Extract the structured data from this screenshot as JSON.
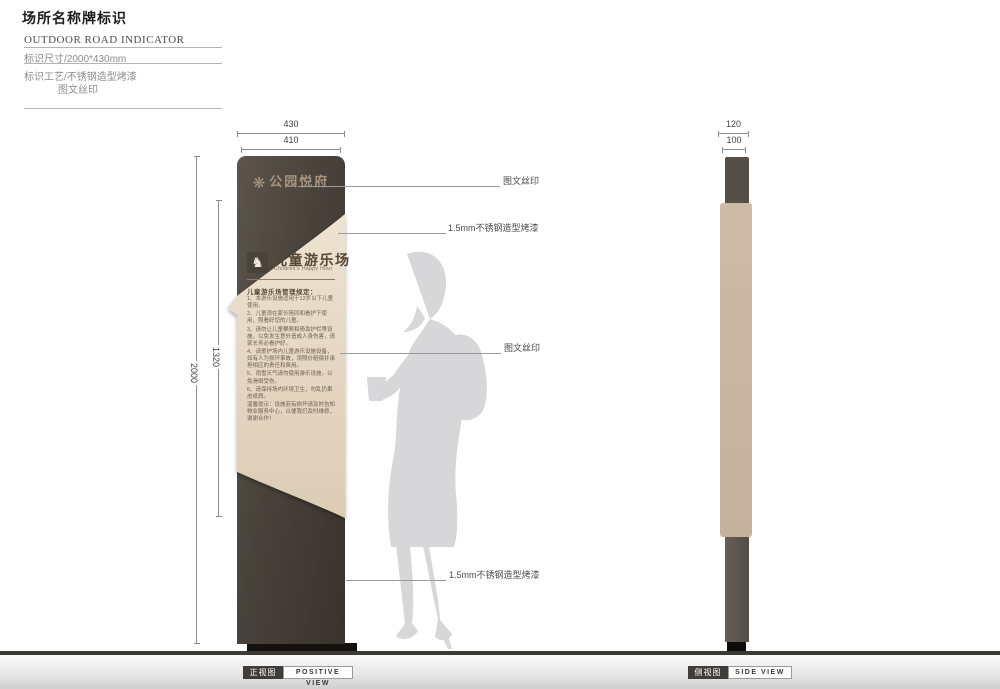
{
  "header": {
    "title": "场所名称牌标识",
    "subtitle": "OUTDOOR ROAD INDICATOR",
    "size_spec": "标识尺寸/2000*430mm",
    "craft_spec_line1": "标识工艺/不锈钢造型烤漆",
    "craft_spec_line2": "图文丝印"
  },
  "front_view": {
    "dims": {
      "outer_width": "430",
      "inner_width": "410",
      "outer_height": "2000",
      "panel_height": "1320"
    },
    "logo": {
      "emblem_glyph": "❋",
      "name": "公园悦府",
      "subname": "· · · · · · · · ·"
    },
    "panel": {
      "icon_glyph": "♞",
      "title_cn": "儿童游乐场",
      "title_en": "Children's Happy Hour",
      "rules_title": "儿童游乐场管理规定：",
      "rules": [
        "1、本游乐设施适用于12岁以下儿童使用。",
        "2、儿童须在家长陪同和看护下使用，照看好您的儿童。",
        "3、请勿让儿童攀爬和倚靠护栏等设施，以免发生意外造成人身伤害，请家长务必看护好。",
        "4、请爱护场内儿童游乐设施设备，如有人为损坏事故，须照价赔偿并承担相应的责任和费用。",
        "5、雨雪天气请勿使用游乐设施，以免滑倒受伤。",
        "6、请保持场内环境卫生，勿乱扔果皮纸屑。",
        "温馨提示：设施若有损坏请及时告知物业服务中心，以便我们及时维修，谢谢合作！"
      ]
    },
    "label_cn": "正视图",
    "label_en": "POSITIVE VIEW"
  },
  "side_view": {
    "dims": {
      "outer_width": "120",
      "inner_width": "100"
    },
    "label_cn": "侧视图",
    "label_en": "SIDE VIEW"
  },
  "annotations": [
    {
      "text": "图文丝印"
    },
    {
      "text": "1.5mm不锈钢造型烤漆"
    },
    {
      "text": "图文丝印"
    },
    {
      "text": "1.5mm不锈钢造型烤漆"
    }
  ],
  "colors": {
    "pillar": "#4a433c",
    "cream_panel": "#e8dccb",
    "side_panel": "#c9b7a2",
    "silhouette": "#d7d7d9",
    "logo_text": "#a8947d"
  }
}
